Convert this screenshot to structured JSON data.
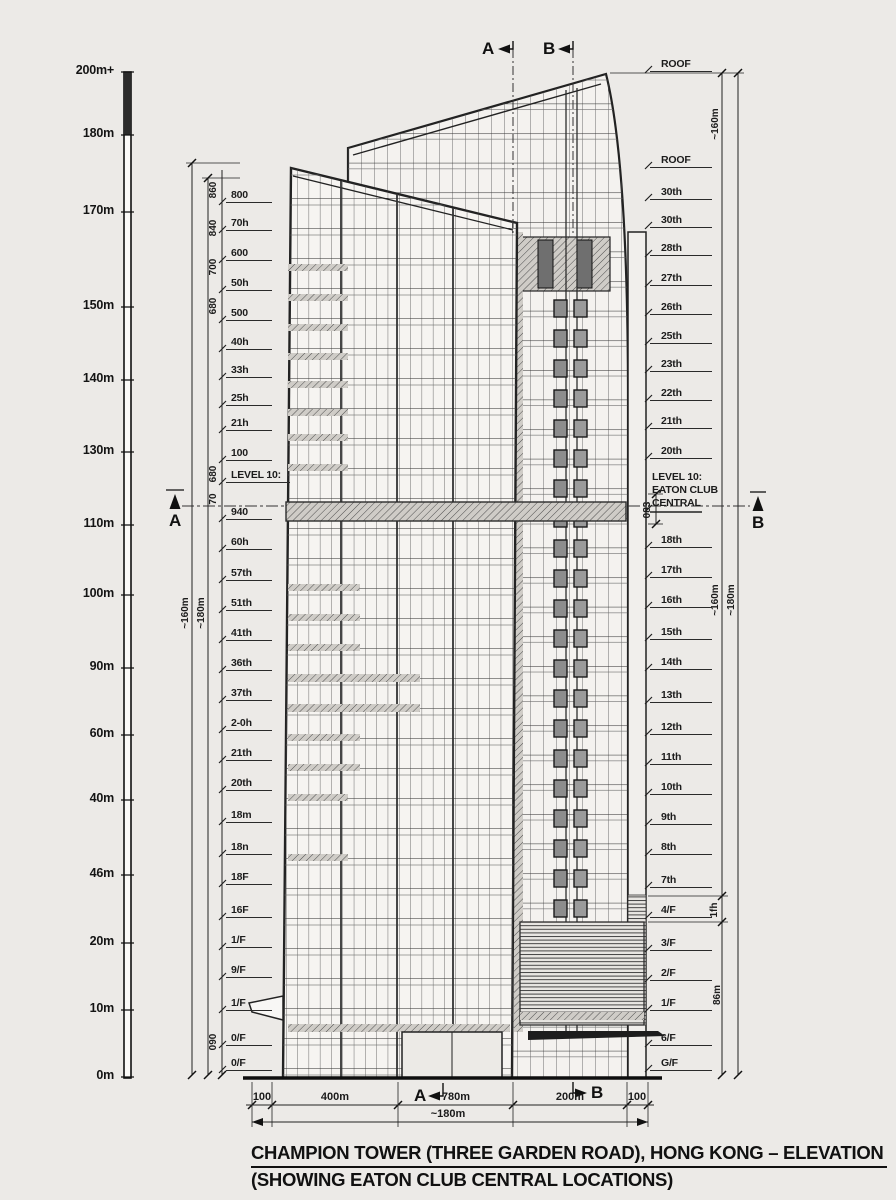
{
  "title": {
    "line1": "CHAMPION TOWER (THREE GARDEN ROAD), HONG KONG – ELEVATION",
    "line2": "(SHOWING EATON CLUB CENTRAL LOCATIONS)"
  },
  "scale_labels": [
    "200m+",
    "180m",
    "170m",
    "150m",
    "140m",
    "130m",
    "110m",
    "100m",
    "90m",
    "60m",
    "40m",
    "46m",
    "20m",
    "10m",
    "0m"
  ],
  "left_floors": [
    "800",
    "70h",
    "600",
    "50h",
    "500",
    "40h",
    "33h",
    "25h",
    "21h",
    "100",
    "LEVEL 10:",
    "940",
    "60h",
    "57th",
    "51th",
    "41th",
    "36th",
    "37th",
    "2-0h",
    "21th",
    "20th",
    "18m",
    "18n",
    "18F",
    "16F",
    "1/F",
    "9/F",
    "1/F",
    "0/F",
    "0/F"
  ],
  "right_floors": [
    "ROOF",
    "ROOF",
    "30th",
    "30th",
    "28th",
    "27th",
    "26th",
    "25th",
    "23th",
    "22th",
    "21th",
    "20th",
    "18th",
    "17th",
    "16th",
    "15th",
    "14th",
    "13th",
    "12th",
    "11th",
    "10th",
    "9th",
    "8th",
    "7th",
    "4/F",
    "3/F",
    "2/F",
    "1/F",
    "6/F",
    "G/F"
  ],
  "right_level10": {
    "l1": "LEVEL 10:",
    "l2": "EATON CLUB",
    "l3": "CENTRAL"
  },
  "dim_labels": {
    "left_outer": "~160m",
    "left_inner": "~180m",
    "right_top": "~160m",
    "right_mid": "~160m",
    "right_outer": "~180m",
    "seg_1fh": "1fh",
    "seg_86m": "86m",
    "band": "083"
  },
  "left_dim_numbers": [
    "860",
    "840",
    "700",
    "680",
    "680",
    "70",
    "090"
  ],
  "bottom_dims": {
    "s1": "100",
    "s2": "400m",
    "s3": "780m",
    "s4": "200m",
    "s5": "100",
    "total": "~180m"
  },
  "markers": {
    "a": "A",
    "b": "B"
  },
  "colors": {
    "paper": "#eceae7",
    "ink": "#1c1c1c"
  }
}
